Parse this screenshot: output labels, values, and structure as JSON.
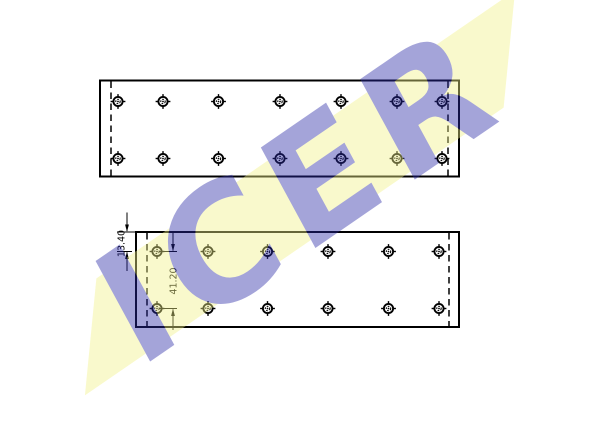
{
  "watermark": {
    "text": "ICER",
    "band_color": "#f3f388",
    "letter_color": "#2929a7",
    "opacity": 0.42,
    "angle_deg": -34.5
  },
  "drawing": {
    "line_color": "#000000",
    "dim_top_offset": "13.40",
    "dim_row_spacing": "41.20",
    "plates": [
      {
        "name": "upper-lining-plate",
        "x": 100,
        "y": 80.5,
        "width": 359,
        "height": 96,
        "dashed_lines_x": [
          111,
          448
        ],
        "hole_rows_y": [
          101.5,
          158.5
        ],
        "hole_cols_x": [
          118,
          163,
          218.5,
          280,
          341,
          397,
          442
        ]
      },
      {
        "name": "lower-lining-plate",
        "x": 136,
        "y": 232,
        "width": 323,
        "height": 95,
        "dashed_lines_x": [
          147,
          449
        ],
        "hole_rows_y": [
          251.5,
          308.5
        ],
        "hole_cols_x": [
          157,
          208,
          267.5,
          328,
          388.5,
          439
        ]
      }
    ]
  }
}
